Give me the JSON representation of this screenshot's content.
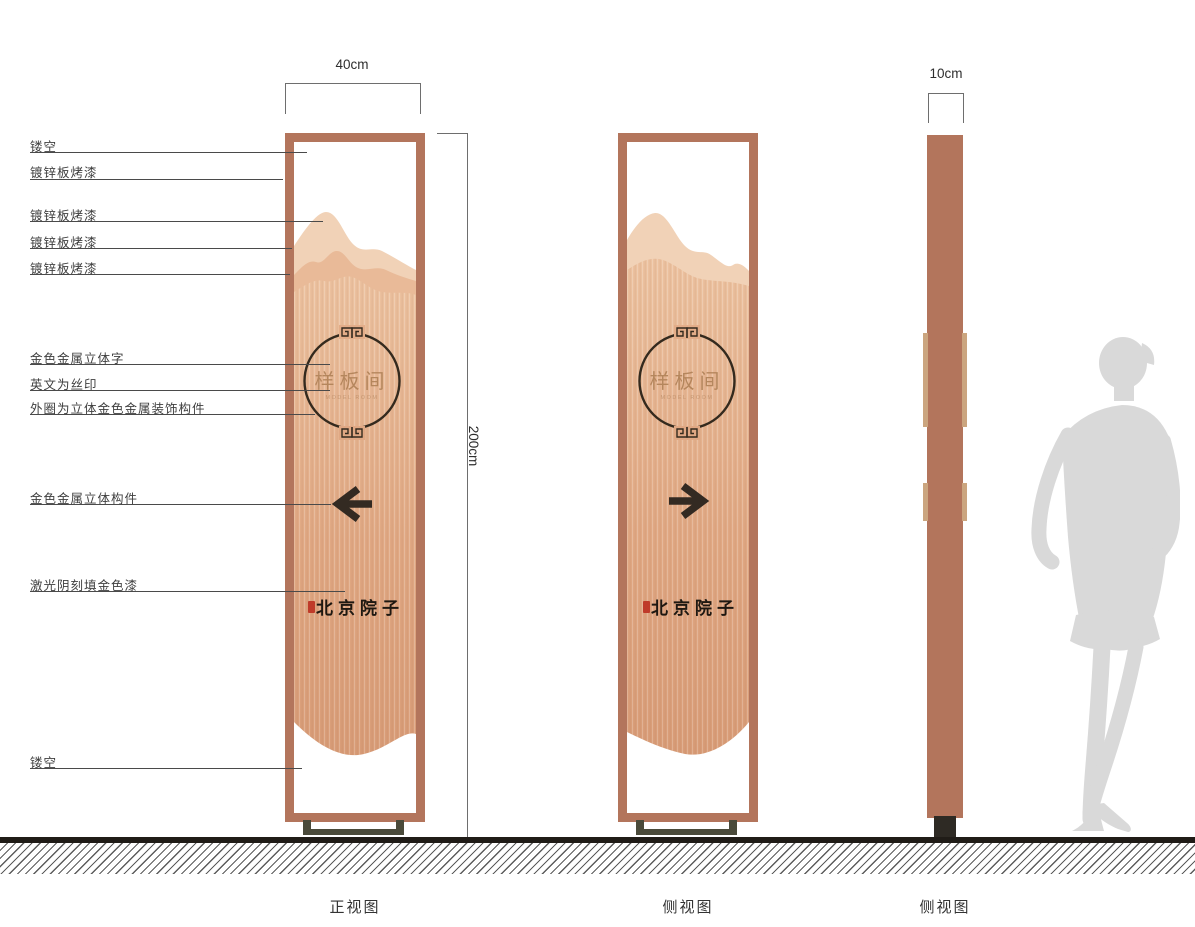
{
  "drawing": {
    "callouts": [
      {
        "text": "镂空"
      },
      {
        "text": "镀锌板烤漆"
      },
      {
        "text": "镀锌板烤漆"
      },
      {
        "text": "镀锌板烤漆"
      },
      {
        "text": "镀锌板烤漆"
      },
      {
        "text": "金色金属立体字"
      },
      {
        "text": "英文为丝印"
      },
      {
        "text": "外圈为立体金色金属装饰构件"
      },
      {
        "text": "金色金属立体构件"
      },
      {
        "text": "激光阴刻填金色漆"
      },
      {
        "text": "镂空"
      }
    ],
    "dimensions": {
      "front_width": "40cm",
      "height": "200cm",
      "profile_width": "10cm"
    },
    "views": {
      "front": {
        "caption": "正视图",
        "arrow_direction": "left"
      },
      "side": {
        "caption": "侧视图",
        "arrow_direction": "right"
      },
      "profile": {
        "caption": "侧视图"
      }
    },
    "sign_content": {
      "room_name": "样板间",
      "english_subtitle": "MODEL ROOM",
      "brand": "北京院子"
    },
    "colors": {
      "frame_copper": "#b3755c",
      "panel_light": "#ecc2a0",
      "panel_dark": "#d89c77",
      "mountain_back": "#f1d2b7",
      "mountain_mid": "#e9ba98",
      "ornament_dark": "#342a1e",
      "gold_text": "#b08157",
      "base_metal": "#4a4a3a",
      "seal_red": "#bf3b2a",
      "silhouette_gray": "#d9d9d9"
    }
  }
}
